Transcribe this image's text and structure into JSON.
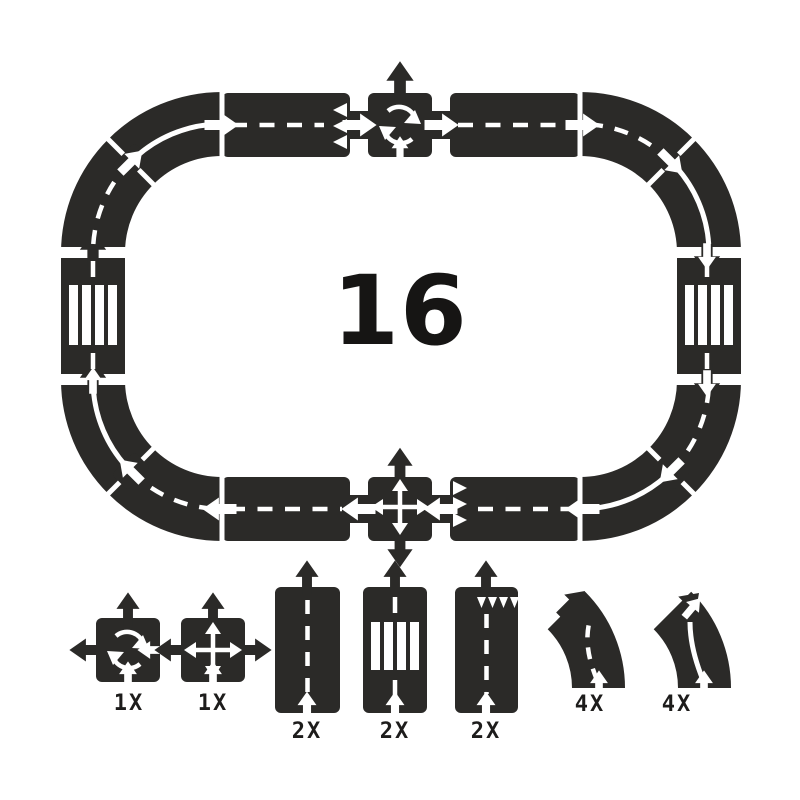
{
  "image": {
    "description": "Flexible toy road track set – contents diagram",
    "background_color": "#ffffff",
    "piece_color": "#2b2a28",
    "marking_color": "#ffffff"
  },
  "set": {
    "total_count": "16",
    "track_layout_clockwise_from_top_left": [
      "curve-solid-line",
      "straight-give-way",
      "roundabout",
      "straight-road",
      "curve-dashed-line",
      "curve-solid-line",
      "pedestrian-crossing",
      "curve-dashed-line",
      "curve-solid-line",
      "straight-give-way",
      "crossroad-intersection",
      "straight-road",
      "curve-dashed-line",
      "curve-solid-line",
      "pedestrian-crossing",
      "curve-dashed-line"
    ]
  },
  "legend": {
    "items": [
      {
        "piece": "roundabout",
        "qty": "1X"
      },
      {
        "piece": "crossroad-intersection",
        "qty": "1X"
      },
      {
        "piece": "straight-road",
        "qty": "2X"
      },
      {
        "piece": "pedestrian-crossing",
        "qty": "2X"
      },
      {
        "piece": "straight-give-way",
        "qty": "2X"
      },
      {
        "piece": "curve-dashed-line",
        "qty": "4X"
      },
      {
        "piece": "curve-solid-line",
        "qty": "4X"
      }
    ]
  }
}
